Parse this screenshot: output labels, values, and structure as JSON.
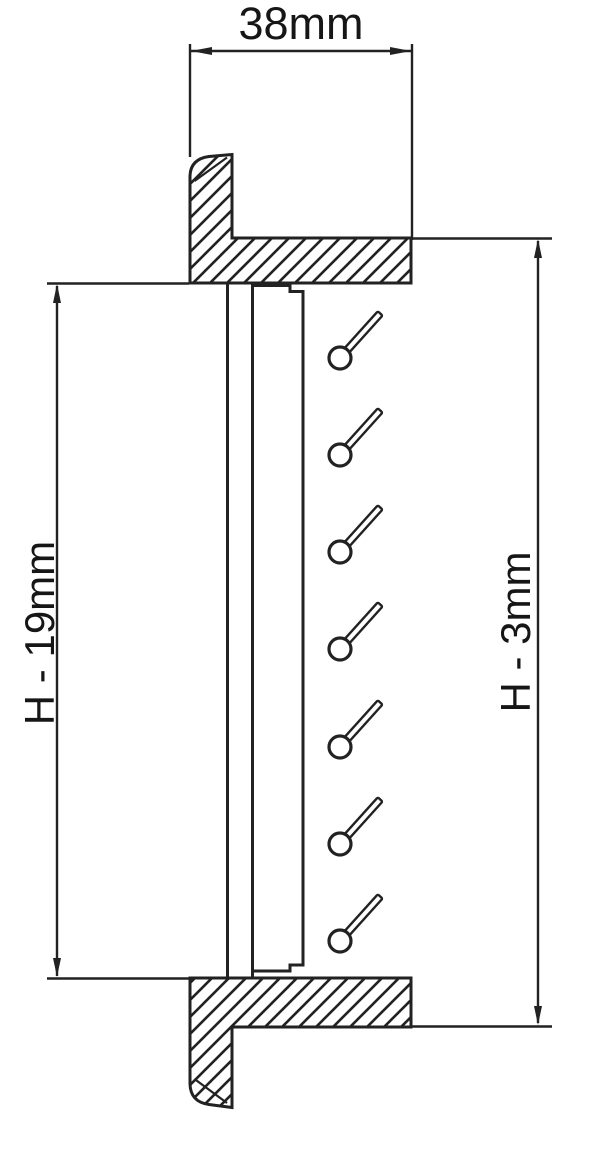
{
  "drawing": {
    "title": "Louver frame cross-section",
    "background_color": "#ffffff",
    "line_color": "#222222",
    "dimensions": {
      "width_top": {
        "label": "38mm"
      },
      "height_left": {
        "label": "H - 19mm"
      },
      "height_right": {
        "label": "H - 3mm"
      }
    },
    "louver_blades": {
      "count": 7,
      "center_x": 340,
      "center_ys": [
        358,
        455,
        552,
        649,
        747,
        844,
        941
      ],
      "blade_angle_deg": -48
    }
  }
}
